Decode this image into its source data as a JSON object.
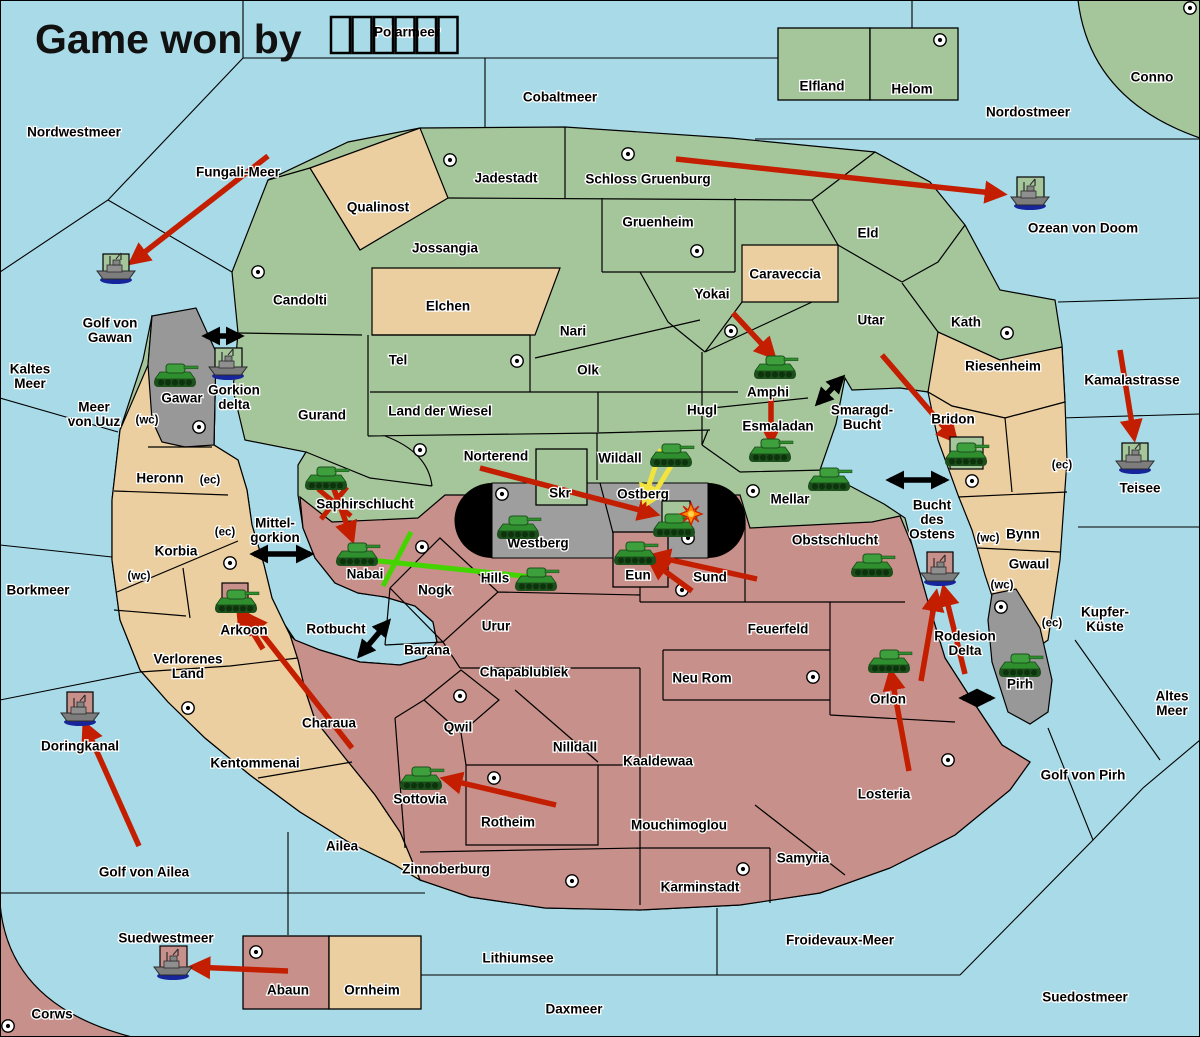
{
  "title": {
    "text": "Game won by",
    "winner_glyph_boxes": 6
  },
  "colors": {
    "sea": "#a8dae7",
    "green_land": "#a5c69b",
    "tan_land": "#eccfa0",
    "pink_land": "#c8908a",
    "gray_land": "#989898",
    "pill_black": "#000000",
    "pill_gray": "#9e9e9e",
    "arrow_red": "#c41e00",
    "arrow_yellow": "#f2e43c",
    "arrow_green": "#44d500",
    "arrow_black": "#000000",
    "sc_fill": "#ffffff",
    "owner_green": "#a5c69b",
    "owner_pink": "#c8908a"
  },
  "labels": [
    {
      "id": "nordwestmeer",
      "lines": [
        "Nordwestmeer"
      ],
      "x": 74,
      "y": 132
    },
    {
      "id": "polarmeer",
      "lines": [
        "Polarmeer"
      ],
      "x": 407,
      "y": 32
    },
    {
      "id": "cobaltmeer",
      "lines": [
        "Cobaltmeer"
      ],
      "x": 560,
      "y": 97
    },
    {
      "id": "nordostmeer",
      "lines": [
        "Nordostmeer"
      ],
      "x": 1028,
      "y": 112
    },
    {
      "id": "conno",
      "lines": [
        "Conno"
      ],
      "x": 1152,
      "y": 77
    },
    {
      "id": "fungali-meer",
      "lines": [
        "Fungali-Meer"
      ],
      "x": 238,
      "y": 172
    },
    {
      "id": "ozean-von-doom",
      "lines": [
        "Ozean von Doom"
      ],
      "x": 1083,
      "y": 228
    },
    {
      "id": "golf-von-gawan",
      "lines": [
        "Golf von",
        "Gawan"
      ],
      "x": 110,
      "y": 323
    },
    {
      "id": "kaltes-meer",
      "lines": [
        "Kaltes",
        "Meer"
      ],
      "x": 30,
      "y": 369
    },
    {
      "id": "meer-von-uuz",
      "lines": [
        "Meer",
        "von Uuz"
      ],
      "x": 94,
      "y": 407
    },
    {
      "id": "kamalastrasse",
      "lines": [
        "Kamalastrasse"
      ],
      "x": 1132,
      "y": 380
    },
    {
      "id": "teisee",
      "lines": [
        "Teisee"
      ],
      "x": 1140,
      "y": 488
    },
    {
      "id": "borkmeer",
      "lines": [
        "Borkmeer"
      ],
      "x": 38,
      "y": 590
    },
    {
      "id": "mittel-gorkion",
      "lines": [
        "Mittel-",
        "gorkion"
      ],
      "x": 275,
      "y": 523
    },
    {
      "id": "rotbucht",
      "lines": [
        "Rotbucht"
      ],
      "x": 336,
      "y": 629
    },
    {
      "id": "smaragd-bucht",
      "lines": [
        "Smaragd-",
        "Bucht"
      ],
      "x": 862,
      "y": 410
    },
    {
      "id": "bucht-des-ostens",
      "lines": [
        "Bucht",
        "des",
        "Ostens"
      ],
      "x": 932,
      "y": 505
    },
    {
      "id": "kupfer-kueste",
      "lines": [
        "Kupfer-",
        "Küste"
      ],
      "x": 1105,
      "y": 612
    },
    {
      "id": "altes-meer",
      "lines": [
        "Altes",
        "Meer"
      ],
      "x": 1172,
      "y": 696
    },
    {
      "id": "golf-von-pirh",
      "lines": [
        "Golf von Pirh"
      ],
      "x": 1083,
      "y": 775
    },
    {
      "id": "golf-von-ailea",
      "lines": [
        "Golf von Ailea"
      ],
      "x": 144,
      "y": 872
    },
    {
      "id": "doringkanal",
      "lines": [
        "Doringkanal"
      ],
      "x": 80,
      "y": 746
    },
    {
      "id": "suedwestmeer",
      "lines": [
        "Suedwestmeer"
      ],
      "x": 166,
      "y": 938
    },
    {
      "id": "lithiumsee",
      "lines": [
        "Lithiumsee"
      ],
      "x": 518,
      "y": 958
    },
    {
      "id": "daxmeer",
      "lines": [
        "Daxmeer"
      ],
      "x": 574,
      "y": 1009
    },
    {
      "id": "froidevaux-meer",
      "lines": [
        "Froidevaux-Meer"
      ],
      "x": 840,
      "y": 940
    },
    {
      "id": "suedostmeer",
      "lines": [
        "Suedostmeer"
      ],
      "x": 1085,
      "y": 997
    },
    {
      "id": "rodesion-delta",
      "lines": [
        "Rodesion",
        "Delta"
      ],
      "x": 965,
      "y": 636
    },
    {
      "id": "elfland",
      "lines": [
        "Elfland"
      ],
      "x": 822,
      "y": 86
    },
    {
      "id": "helom",
      "lines": [
        "Helom"
      ],
      "x": 912,
      "y": 89
    },
    {
      "id": "jadestadt",
      "lines": [
        "Jadestadt"
      ],
      "x": 506,
      "y": 178
    },
    {
      "id": "schloss-gruenburg",
      "lines": [
        "Schloss Gruenburg"
      ],
      "x": 648,
      "y": 179
    },
    {
      "id": "qualinost",
      "lines": [
        "Qualinost"
      ],
      "x": 378,
      "y": 207
    },
    {
      "id": "jossangia",
      "lines": [
        "Jossangia"
      ],
      "x": 445,
      "y": 248
    },
    {
      "id": "gruenheim",
      "lines": [
        "Gruenheim"
      ],
      "x": 658,
      "y": 222
    },
    {
      "id": "candolti",
      "lines": [
        "Candolti"
      ],
      "x": 300,
      "y": 300
    },
    {
      "id": "elchen",
      "lines": [
        "Elchen"
      ],
      "x": 448,
      "y": 306
    },
    {
      "id": "eld",
      "lines": [
        "Eld"
      ],
      "x": 868,
      "y": 233
    },
    {
      "id": "caraveccia",
      "lines": [
        "Caraveccia"
      ],
      "x": 785,
      "y": 274
    },
    {
      "id": "yokai",
      "lines": [
        "Yokai"
      ],
      "x": 712,
      "y": 294
    },
    {
      "id": "utar",
      "lines": [
        "Utar"
      ],
      "x": 871,
      "y": 320
    },
    {
      "id": "kath",
      "lines": [
        "Kath"
      ],
      "x": 966,
      "y": 322
    },
    {
      "id": "riesenheim",
      "lines": [
        "Riesenheim"
      ],
      "x": 1003,
      "y": 366
    },
    {
      "id": "bridon",
      "lines": [
        "Bridon"
      ],
      "x": 953,
      "y": 419
    },
    {
      "id": "nari",
      "lines": [
        "Nari"
      ],
      "x": 573,
      "y": 331
    },
    {
      "id": "olk",
      "lines": [
        "Olk"
      ],
      "x": 588,
      "y": 370
    },
    {
      "id": "tel",
      "lines": [
        "Tel"
      ],
      "x": 398,
      "y": 360
    },
    {
      "id": "land-der-wiesel",
      "lines": [
        "Land der Wiesel"
      ],
      "x": 440,
      "y": 411
    },
    {
      "id": "hugl",
      "lines": [
        "Hugl"
      ],
      "x": 702,
      "y": 410
    },
    {
      "id": "gurand",
      "lines": [
        "Gurand"
      ],
      "x": 322,
      "y": 415
    },
    {
      "id": "amphi",
      "lines": [
        "Amphi"
      ],
      "x": 768,
      "y": 392
    },
    {
      "id": "esmaladan",
      "lines": [
        "Esmaladan"
      ],
      "x": 778,
      "y": 426
    },
    {
      "id": "norterend",
      "lines": [
        "Norterend"
      ],
      "x": 496,
      "y": 456
    },
    {
      "id": "wildall",
      "lines": [
        "Wildall"
      ],
      "x": 620,
      "y": 458
    },
    {
      "id": "mellar",
      "lines": [
        "Mellar"
      ],
      "x": 790,
      "y": 499
    },
    {
      "id": "gawar",
      "lines": [
        "Gawar"
      ],
      "x": 182,
      "y": 398
    },
    {
      "id": "gorkion-delta",
      "lines": [
        "Gorkion",
        "delta"
      ],
      "x": 234,
      "y": 390
    },
    {
      "id": "heronn",
      "lines": [
        "Heronn"
      ],
      "x": 160,
      "y": 478
    },
    {
      "id": "korbia",
      "lines": [
        "Korbia"
      ],
      "x": 176,
      "y": 551
    },
    {
      "id": "verlorenes-land",
      "lines": [
        "Verlorenes",
        "Land"
      ],
      "x": 188,
      "y": 659
    },
    {
      "id": "saphirschlucht",
      "lines": [
        "Saphirschlucht"
      ],
      "x": 365,
      "y": 504
    },
    {
      "id": "nabai",
      "lines": [
        "Nabai"
      ],
      "x": 365,
      "y": 574
    },
    {
      "id": "arkoon",
      "lines": [
        "Arkoon"
      ],
      "x": 244,
      "y": 630
    },
    {
      "id": "skr",
      "lines": [
        "Skr"
      ],
      "x": 560,
      "y": 493
    },
    {
      "id": "ostberg",
      "lines": [
        "Ostberg"
      ],
      "x": 643,
      "y": 494
    },
    {
      "id": "westberg",
      "lines": [
        "Westberg"
      ],
      "x": 538,
      "y": 543
    },
    {
      "id": "eun",
      "lines": [
        "Eun"
      ],
      "x": 638,
      "y": 575
    },
    {
      "id": "sund",
      "lines": [
        "Sund"
      ],
      "x": 710,
      "y": 577
    },
    {
      "id": "obstschlucht",
      "lines": [
        "Obstschlucht"
      ],
      "x": 835,
      "y": 540
    },
    {
      "id": "hills",
      "lines": [
        "Hills"
      ],
      "x": 495,
      "y": 578
    },
    {
      "id": "nogk",
      "lines": [
        "Nogk"
      ],
      "x": 435,
      "y": 590
    },
    {
      "id": "urur",
      "lines": [
        "Urur"
      ],
      "x": 496,
      "y": 626
    },
    {
      "id": "barana",
      "lines": [
        "Barana"
      ],
      "x": 427,
      "y": 650
    },
    {
      "id": "chapablublek",
      "lines": [
        "Chapablublek"
      ],
      "x": 524,
      "y": 672
    },
    {
      "id": "qwil",
      "lines": [
        "Qwil"
      ],
      "x": 458,
      "y": 727
    },
    {
      "id": "nilldall",
      "lines": [
        "Nilldall"
      ],
      "x": 575,
      "y": 747
    },
    {
      "id": "kaaldewaa",
      "lines": [
        "Kaaldewaa"
      ],
      "x": 658,
      "y": 761
    },
    {
      "id": "neu-rom",
      "lines": [
        "Neu Rom"
      ],
      "x": 702,
      "y": 678
    },
    {
      "id": "feuerfeld",
      "lines": [
        "Feuerfeld"
      ],
      "x": 778,
      "y": 629
    },
    {
      "id": "rotheim",
      "lines": [
        "Rotheim"
      ],
      "x": 508,
      "y": 822
    },
    {
      "id": "sottovia",
      "lines": [
        "Sottovia"
      ],
      "x": 420,
      "y": 799
    },
    {
      "id": "mouchimoglou",
      "lines": [
        "Mouchimoglou"
      ],
      "x": 679,
      "y": 825
    },
    {
      "id": "charaua",
      "lines": [
        "Charaua"
      ],
      "x": 329,
      "y": 723
    },
    {
      "id": "kentommenai",
      "lines": [
        "Kentommenai"
      ],
      "x": 255,
      "y": 763
    },
    {
      "id": "ailea",
      "lines": [
        "Ailea"
      ],
      "x": 342,
      "y": 846
    },
    {
      "id": "zinnoberburg",
      "lines": [
        "Zinnoberburg"
      ],
      "x": 446,
      "y": 869
    },
    {
      "id": "karminstadt",
      "lines": [
        "Karminstadt"
      ],
      "x": 700,
      "y": 887
    },
    {
      "id": "samyria",
      "lines": [
        "Samyria"
      ],
      "x": 803,
      "y": 858
    },
    {
      "id": "losteria",
      "lines": [
        "Losteria"
      ],
      "x": 884,
      "y": 794
    },
    {
      "id": "orlon",
      "lines": [
        "Orlon"
      ],
      "x": 888,
      "y": 699
    },
    {
      "id": "abaun",
      "lines": [
        "Abaun"
      ],
      "x": 288,
      "y": 990
    },
    {
      "id": "ornheim",
      "lines": [
        "Ornheim"
      ],
      "x": 372,
      "y": 990
    },
    {
      "id": "corws",
      "lines": [
        "Corws"
      ],
      "x": 52,
      "y": 1014
    },
    {
      "id": "bynn",
      "lines": [
        "Bynn"
      ],
      "x": 1023,
      "y": 534
    },
    {
      "id": "gwaul",
      "lines": [
        "Gwaul"
      ],
      "x": 1029,
      "y": 564
    },
    {
      "id": "pirh",
      "lines": [
        "Pirh"
      ],
      "x": 1020,
      "y": 684
    },
    {
      "id": "wc-uuz",
      "lines": [
        "(wc)"
      ],
      "x": 147,
      "y": 419,
      "sm": true
    },
    {
      "id": "ec-heronn",
      "lines": [
        "(ec)"
      ],
      "x": 210,
      "y": 479,
      "sm": true
    },
    {
      "id": "ec-korbia",
      "lines": [
        "(ec)"
      ],
      "x": 225,
      "y": 531,
      "sm": true
    },
    {
      "id": "wc-korbia",
      "lines": [
        "(wc)"
      ],
      "x": 139,
      "y": 575,
      "sm": true
    },
    {
      "id": "ec-bynn-n",
      "lines": [
        "(ec)"
      ],
      "x": 1062,
      "y": 464,
      "sm": true
    },
    {
      "id": "wc-bynn",
      "lines": [
        "(wc)"
      ],
      "x": 988,
      "y": 537,
      "sm": true
    },
    {
      "id": "wc-gwaul",
      "lines": [
        "(wc)"
      ],
      "x": 1002,
      "y": 584,
      "sm": true
    },
    {
      "id": "ec-gwaul",
      "lines": [
        "(ec)"
      ],
      "x": 1052,
      "y": 622,
      "sm": true
    }
  ],
  "supply_centers": [
    [
      450,
      160
    ],
    [
      628,
      154
    ],
    [
      940,
      40
    ],
    [
      1190,
      8
    ],
    [
      258,
      272
    ],
    [
      697,
      251
    ],
    [
      731,
      331
    ],
    [
      1007,
      333
    ],
    [
      517,
      361
    ],
    [
      420,
      450
    ],
    [
      199,
      427
    ],
    [
      972,
      481
    ],
    [
      753,
      491
    ],
    [
      502,
      494
    ],
    [
      688,
      538
    ],
    [
      682,
      590
    ],
    [
      230,
      563
    ],
    [
      422,
      547
    ],
    [
      188,
      708
    ],
    [
      460,
      696
    ],
    [
      494,
      778
    ],
    [
      572,
      881
    ],
    [
      743,
      869
    ],
    [
      813,
      677
    ],
    [
      948,
      760
    ],
    [
      1001,
      607
    ],
    [
      256,
      952
    ],
    [
      8,
      1026
    ]
  ],
  "units": [
    {
      "type": "tank",
      "place": "gawar",
      "x": 175,
      "y": 374
    },
    {
      "type": "tank",
      "place": "saphirschlucht",
      "x": 326,
      "y": 477
    },
    {
      "type": "tank",
      "place": "nabai",
      "x": 357,
      "y": 553
    },
    {
      "type": "tank",
      "place": "arkoon",
      "x": 236,
      "y": 600,
      "box": {
        "c": "pink",
        "x": 222,
        "y": 583,
        "w": 26,
        "h": 26
      }
    },
    {
      "type": "tank",
      "place": "westberg",
      "x": 518,
      "y": 526
    },
    {
      "type": "tank",
      "place": "hills",
      "x": 536,
      "y": 578
    },
    {
      "type": "tank",
      "place": "eun",
      "x": 635,
      "y": 552
    },
    {
      "type": "tank",
      "place": "ostberg",
      "x": 674,
      "y": 524,
      "box": {
        "c": "green",
        "x": 662,
        "y": 501,
        "w": 28,
        "h": 31
      },
      "explosion": {
        "x": 691,
        "y": 514
      }
    },
    {
      "type": "tank",
      "place": "wildall",
      "x": 671,
      "y": 454
    },
    {
      "type": "tank",
      "place": "amphi",
      "x": 775,
      "y": 366
    },
    {
      "type": "tank",
      "place": "esmaladan",
      "x": 770,
      "y": 449
    },
    {
      "type": "tank",
      "place": "mellar",
      "x": 829,
      "y": 478
    },
    {
      "type": "tank",
      "place": "obstschlucht",
      "x": 872,
      "y": 564
    },
    {
      "type": "tank",
      "place": "orlon",
      "x": 889,
      "y": 660
    },
    {
      "type": "tank",
      "place": "sottovia",
      "x": 421,
      "y": 777
    },
    {
      "type": "tank",
      "place": "bridon",
      "x": 966,
      "y": 453,
      "box": {
        "c": "green",
        "x": 950,
        "y": 437,
        "w": 33,
        "h": 32
      }
    },
    {
      "type": "tank",
      "place": "pirh",
      "x": 1020,
      "y": 664
    },
    {
      "type": "ship",
      "place": "golf-von-gawan",
      "x": 116,
      "y": 270,
      "box": {
        "c": "green",
        "x": 103,
        "y": 254,
        "w": 26,
        "h": 24
      }
    },
    {
      "type": "ship",
      "place": "gorkion-delta",
      "x": 228,
      "y": 366,
      "box": {
        "c": "green",
        "x": 215,
        "y": 348,
        "w": 27,
        "h": 28
      }
    },
    {
      "type": "ship",
      "place": "ozean-von-doom",
      "x": 1030,
      "y": 196,
      "box": {
        "c": "green",
        "x": 1017,
        "y": 177,
        "w": 27,
        "h": 24
      }
    },
    {
      "type": "ship",
      "place": "teisee",
      "x": 1135,
      "y": 460,
      "box": {
        "c": "green",
        "x": 1122,
        "y": 443,
        "w": 26,
        "h": 25
      }
    },
    {
      "type": "ship",
      "place": "rodesion-delta",
      "x": 940,
      "y": 572,
      "box": {
        "c": "pink",
        "x": 927,
        "y": 552,
        "w": 26,
        "h": 25
      }
    },
    {
      "type": "ship",
      "place": "doringkanal",
      "x": 80,
      "y": 712,
      "box": {
        "c": "pink",
        "x": 67,
        "y": 692,
        "w": 26,
        "h": 25
      }
    },
    {
      "type": "ship",
      "place": "suedwestmeer",
      "x": 173,
      "y": 966,
      "box": {
        "c": "pink",
        "x": 160,
        "y": 946,
        "w": 27,
        "h": 26
      }
    }
  ],
  "arrows": {
    "red": [
      [
        268,
        156,
        132,
        262
      ],
      [
        676,
        159,
        1002,
        194
      ],
      [
        1120,
        350,
        1134,
        437
      ],
      [
        733,
        313,
        773,
        356
      ],
      [
        771,
        398,
        771,
        441
      ],
      [
        882,
        355,
        955,
        440
      ],
      [
        331,
        481,
        352,
        539
      ],
      [
        480,
        468,
        655,
        514
      ],
      [
        757,
        579,
        653,
        556
      ],
      [
        692,
        591,
        651,
        561
      ],
      [
        909,
        771,
        891,
        673
      ],
      [
        965,
        674,
        944,
        589
      ],
      [
        921,
        681,
        936,
        594
      ],
      [
        556,
        805,
        445,
        779
      ],
      [
        352,
        748,
        248,
        616
      ],
      [
        263,
        649,
        239,
        610
      ],
      [
        139,
        846,
        85,
        725
      ],
      [
        288,
        971,
        193,
        967
      ]
    ],
    "red_x": [
      [
        318,
        489,
        351,
        516
      ],
      [
        347,
        487,
        321,
        519
      ]
    ],
    "yellow": [
      [
        661,
        449,
        644,
        500
      ],
      [
        674,
        461,
        649,
        502
      ]
    ],
    "green_line": [
      360,
      559,
      542,
      578
    ],
    "green_cross": [
      411,
      532,
      383,
      586
    ],
    "black_double": [
      [
        206,
        336,
        240,
        336
      ],
      [
        254,
        554,
        310,
        554
      ],
      [
        360,
        655,
        388,
        622
      ],
      [
        818,
        403,
        842,
        378
      ],
      [
        890,
        480,
        945,
        480
      ],
      [
        963,
        698,
        991,
        698
      ]
    ]
  }
}
